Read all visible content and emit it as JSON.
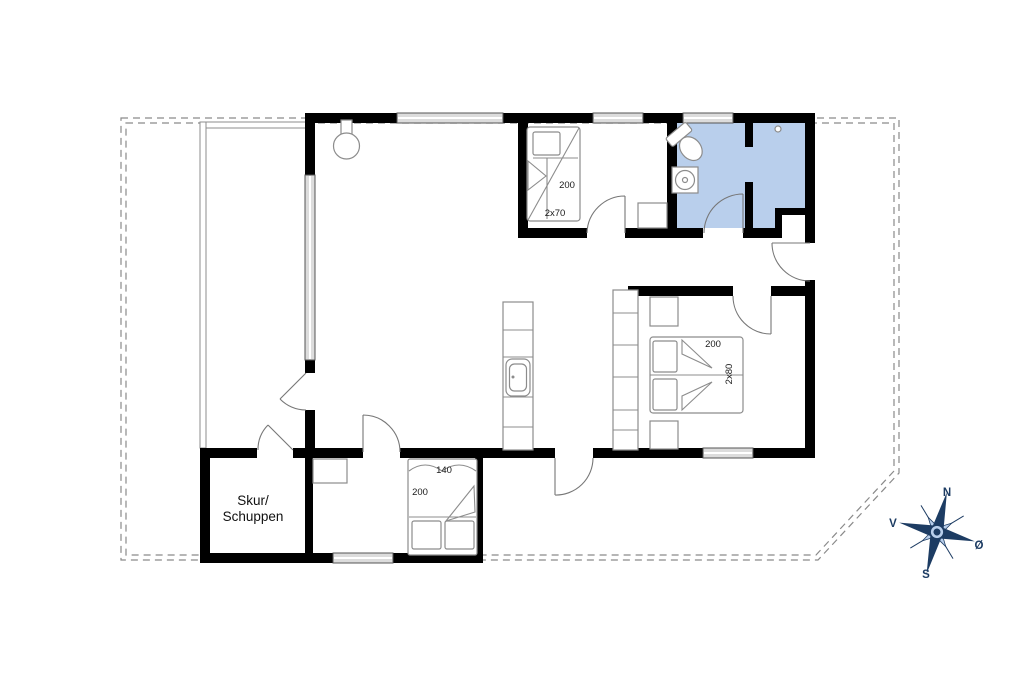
{
  "rooms": {
    "shed_line1": "Skur/",
    "shed_line2": "Schuppen"
  },
  "beds": {
    "bunk": {
      "length": "200",
      "size": "2x70"
    },
    "double": {
      "length": "200",
      "size": "2x80"
    },
    "single": {
      "width": "140",
      "length": "200"
    }
  },
  "compass": {
    "north": "N",
    "east": "Ø",
    "south": "S",
    "west": "V"
  },
  "colors": {
    "wall": "#000000",
    "bathroom_fill": "#b9cfec",
    "window_fill": "#dcdcdc",
    "boundary": "#8a8a8a",
    "furniture_stroke": "#8c8c8c",
    "door_stroke": "#777777",
    "compass": "#1d3c63",
    "label_text": "#1a1a1a"
  }
}
